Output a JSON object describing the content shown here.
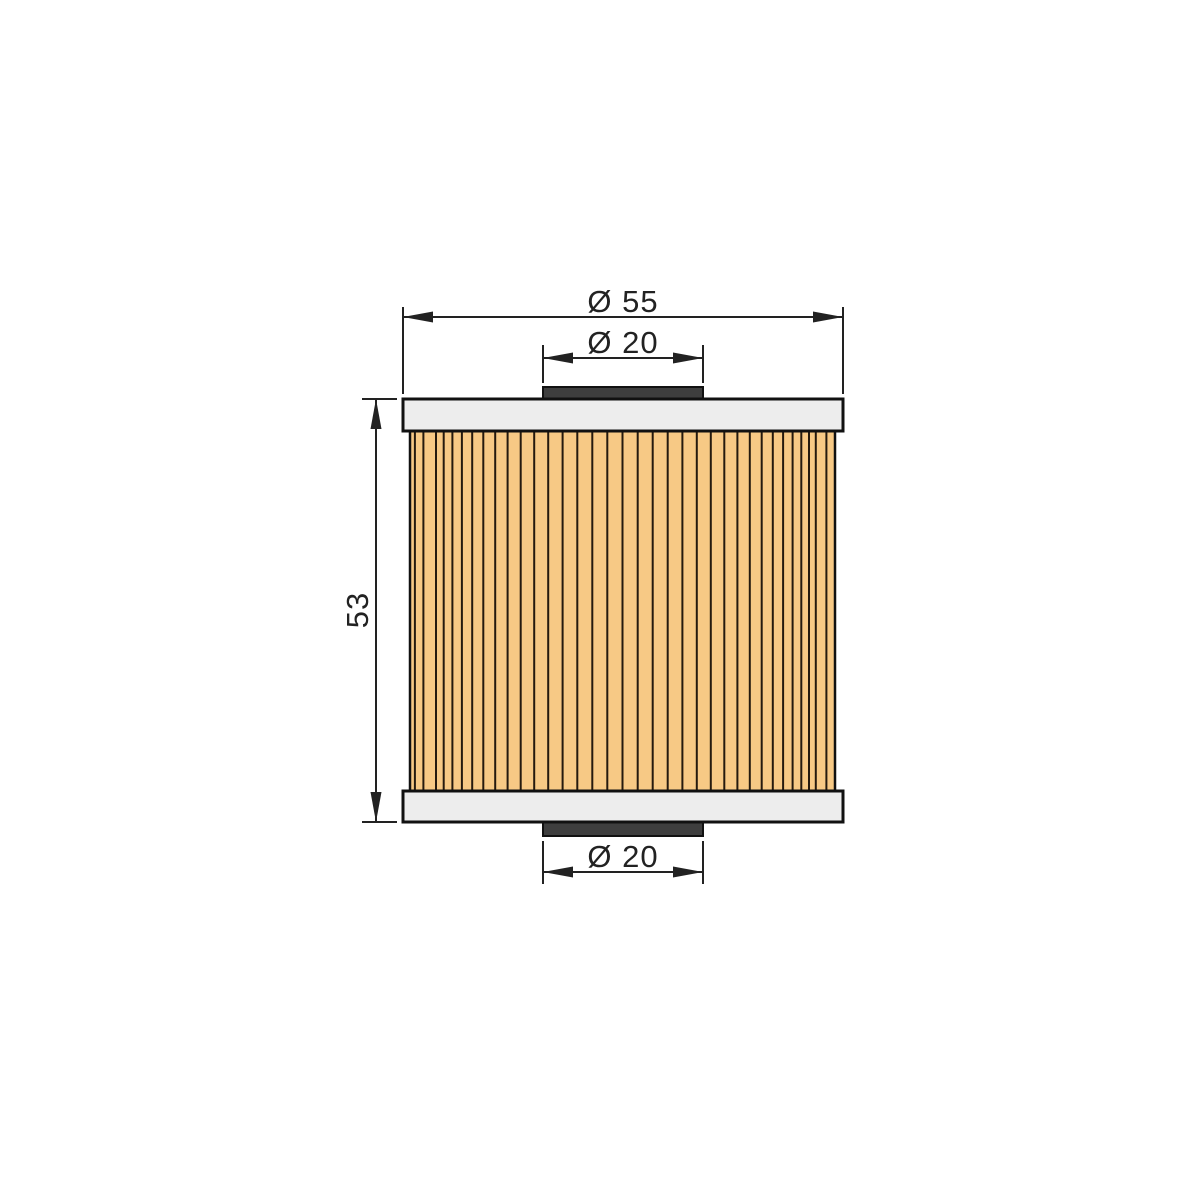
{
  "drawing": {
    "type": "technical-dimension-drawing",
    "subject": "oil-filter-element-side-view",
    "labels": {
      "outer_diameter": "Ø 55",
      "inner_diameter_top": "Ø 20",
      "height": "53",
      "inner_diameter_bottom": "Ø 20"
    },
    "values": {
      "outer_diameter": 55,
      "inner_diameter_top": 20,
      "height": 53,
      "inner_diameter_bottom": 20
    },
    "colors": {
      "background": "#FFFFFF",
      "media": "#F7C985",
      "pleat_line": "#251A0E",
      "end_cap": "#EDEDED",
      "gasket": "#3E3E3E",
      "outline": "#111111",
      "dimension": "#222222"
    }
  }
}
